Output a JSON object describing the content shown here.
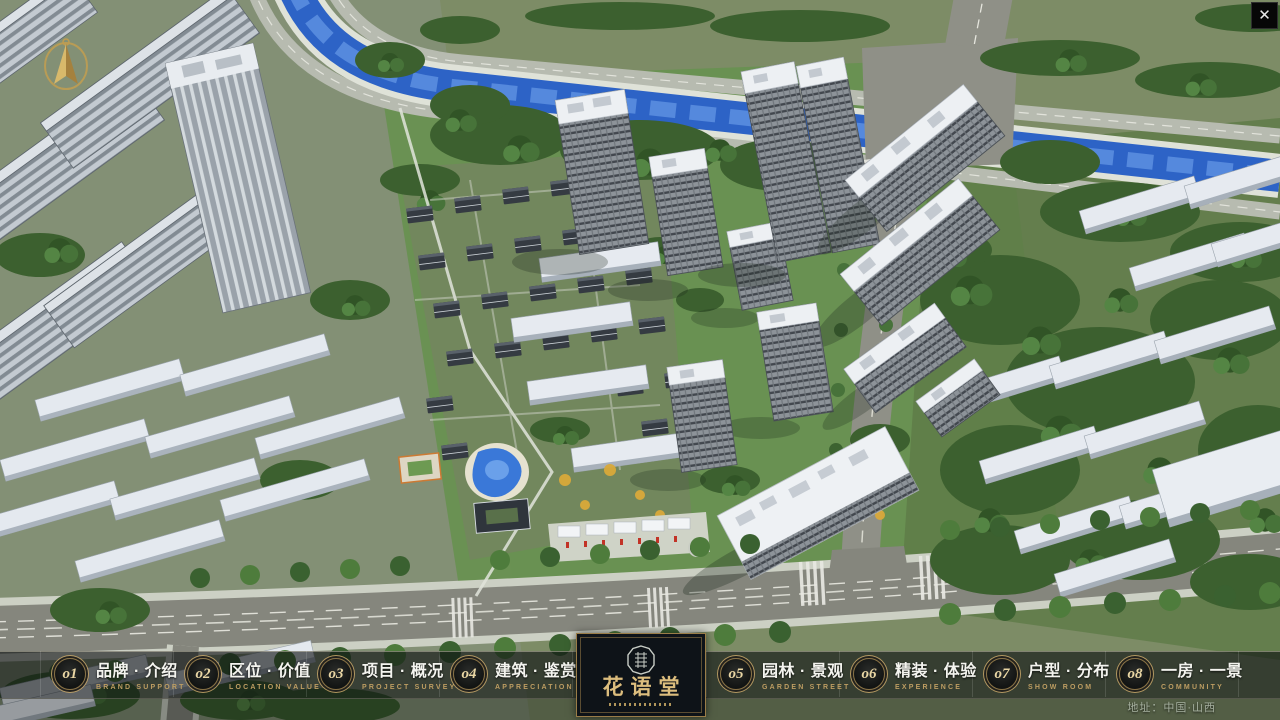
{
  "icons": {
    "close": "✕",
    "compass": "gold-north-arrow",
    "logo_seal": "octagon-seal"
  },
  "nav": {
    "items": [
      {
        "num": "o1",
        "zh": "品牌 · 介绍",
        "en": "BRAND SUPPORT"
      },
      {
        "num": "o2",
        "zh": "区位 · 价值",
        "en": "LOCATION VALUE"
      },
      {
        "num": "o3",
        "zh": "项目 · 概况",
        "en": "PROJECT SURVEY"
      },
      {
        "num": "o4",
        "zh": "建筑 · 鉴赏",
        "en": "APPRECIATION"
      },
      {
        "num": "o5",
        "zh": "园林 · 景观",
        "en": "GARDEN STREET"
      },
      {
        "num": "o6",
        "zh": "精装 · 体验",
        "en": "EXPERIENCE"
      },
      {
        "num": "o7",
        "zh": "户型 · 分布",
        "en": "SHOW ROOM"
      },
      {
        "num": "o8",
        "zh": "一房 · 一景",
        "en": "COMMUNITY"
      }
    ]
  },
  "logo": {
    "title": "花语堂"
  },
  "footer": {
    "address": "地址：中国·山西"
  },
  "colors": {
    "gold": "#c6a263",
    "bar_bg": "rgba(12,14,16,0.62)",
    "river_blue": "#2d63c6",
    "plaque_bg": "#0e1318"
  }
}
